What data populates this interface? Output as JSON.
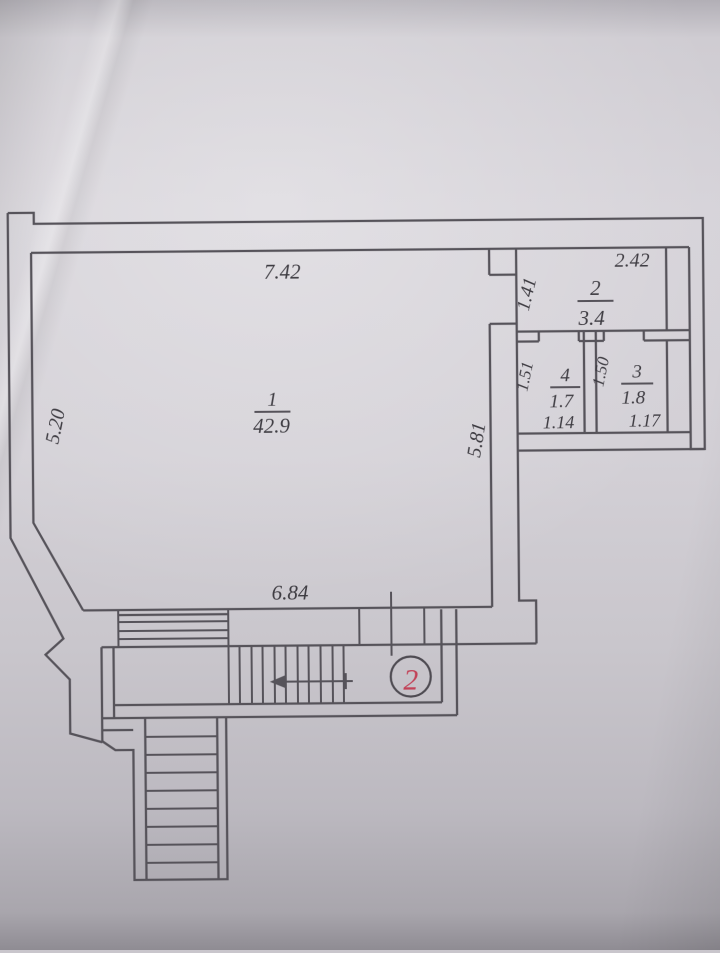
{
  "document_type": "apartment floor plan (photographed paper drawing)",
  "colors": {
    "paper": "#d3d0d6",
    "line": "#56535a",
    "text": "#3e3c42",
    "accent_red": "#c24157"
  },
  "plan": {
    "unit_number": "2",
    "main_room": {
      "number": "1",
      "area": "42.9",
      "dim_top": "7.42",
      "dim_left": "5.20",
      "dim_right": "5.81",
      "dim_bottom": "6.84"
    },
    "room2": {
      "number": "2",
      "area": "3.4",
      "dim_top": "2.42",
      "dim_left": "1.41"
    },
    "room3": {
      "number": "3",
      "area": "1.8",
      "dim_left": "1.50",
      "dim_bottom": "1.17"
    },
    "room4": {
      "number": "4",
      "area": "1.7",
      "dim_left": "1.51",
      "dim_bottom": "1.14"
    }
  }
}
